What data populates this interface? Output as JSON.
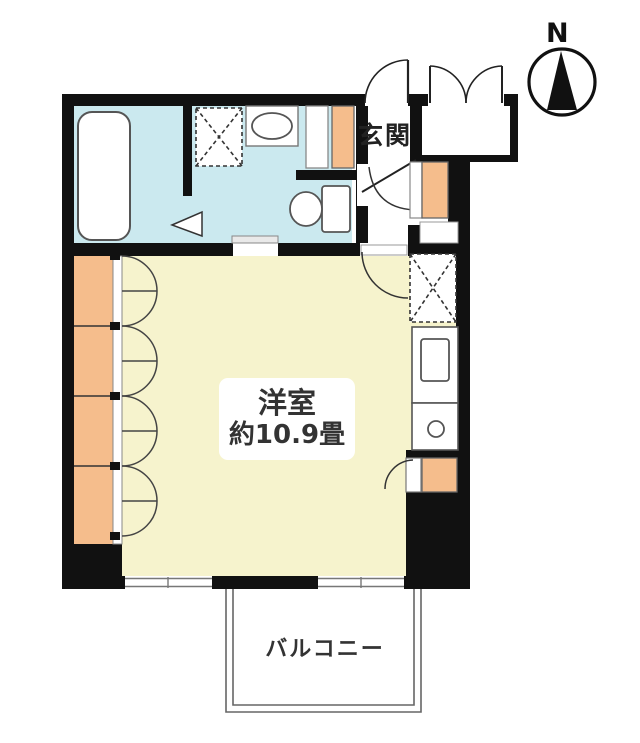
{
  "meta": {
    "type": "japanese-apartment-floor-plan"
  },
  "labels": {
    "north": "N",
    "entrance": "玄関",
    "room_name": "洋室",
    "room_size": "約10.9畳",
    "balcony": "バルコニー"
  },
  "colors": {
    "wall": "#111111",
    "room_floor": "#f6f3cd",
    "wet_area_floor": "#cbe9ef",
    "storage_fill": "#f5bd8c",
    "fixture_outline": "#555555",
    "background": "#ffffff"
  },
  "fixtures": [
    "bathtub",
    "washing-machine-space",
    "wash-basin",
    "toilet",
    "folding-door-marker",
    "sliding-door",
    "entrance-door",
    "storage-double-door",
    "shoe-cabinet",
    "refrigerator-space",
    "kitchen-counter",
    "kitchen-sink",
    "stove-burner",
    "wall-closet",
    "storage-closet",
    "window",
    "balcony",
    "compass"
  ]
}
